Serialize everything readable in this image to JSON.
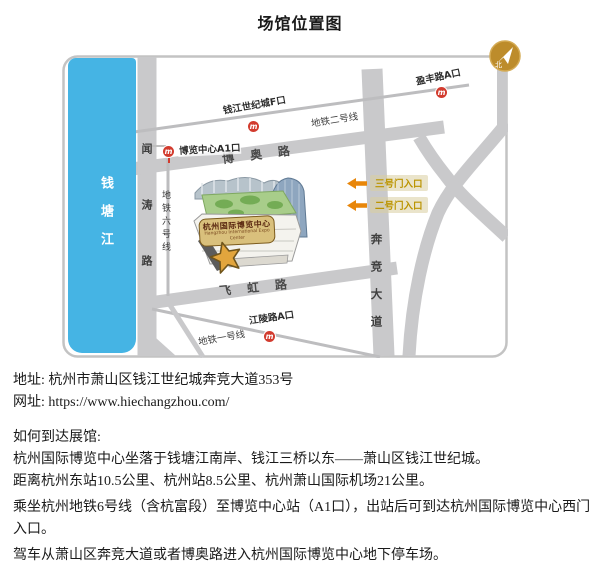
{
  "page": {
    "title": "场馆位置图"
  },
  "map": {
    "compass_label": "北",
    "river_label": "钱塘江",
    "road_labels": {
      "wentao": "闻涛路",
      "boao": "博奥路",
      "feihong": "飞虹路",
      "benjing": "奔竞大道"
    },
    "metro_labels": {
      "line2": "地铁二号线",
      "line6": "地铁六号线",
      "line1": "地铁一号线"
    },
    "stations": {
      "qianjiang_f": "钱江世纪城F口",
      "yingfeng_a": "盈丰路A口",
      "bolan_a1": "博览中心A1口",
      "jiangling_a": "江陵路A口"
    },
    "gates": {
      "gate3": "三号门入口",
      "gate2": "二号门入口"
    },
    "building": {
      "name": "杭州国际博览中心",
      "name_en": "Hangzhou International Expo Center"
    },
    "metro_icon_glyph": "m"
  },
  "info": {
    "address_label": "地址:",
    "address_value": "杭州市萧山区钱江世纪城奔竞大道353号",
    "website_label": "网址:",
    "website_value": "https://www.hiechangzhou.com/",
    "directions_title": "如何到达展馆:",
    "paragraphs": [
      "杭州国际博览中心坐落于钱塘江南岸、钱江三桥以东——萧山区钱江世纪城。",
      "距离杭州东站10.5公里、杭州站8.5公里、杭州萧山国际机场21公里。",
      "乘坐杭州地铁6号线（含杭富段）至博览中心站（A1口），出站后可到达杭州国际博览中心西门入口。",
      "驾车从萧山区奔竞大道或者博奥路进入杭州国际博览中心地下停车场。"
    ]
  },
  "colors": {
    "river": "#45b4e4",
    "road": "#c9c9cb",
    "metro_line": "#bdbdbf",
    "metro_red": "#d23b2e",
    "accent_gold": "#bd8c2b",
    "arrow_orange": "#e8860a"
  }
}
